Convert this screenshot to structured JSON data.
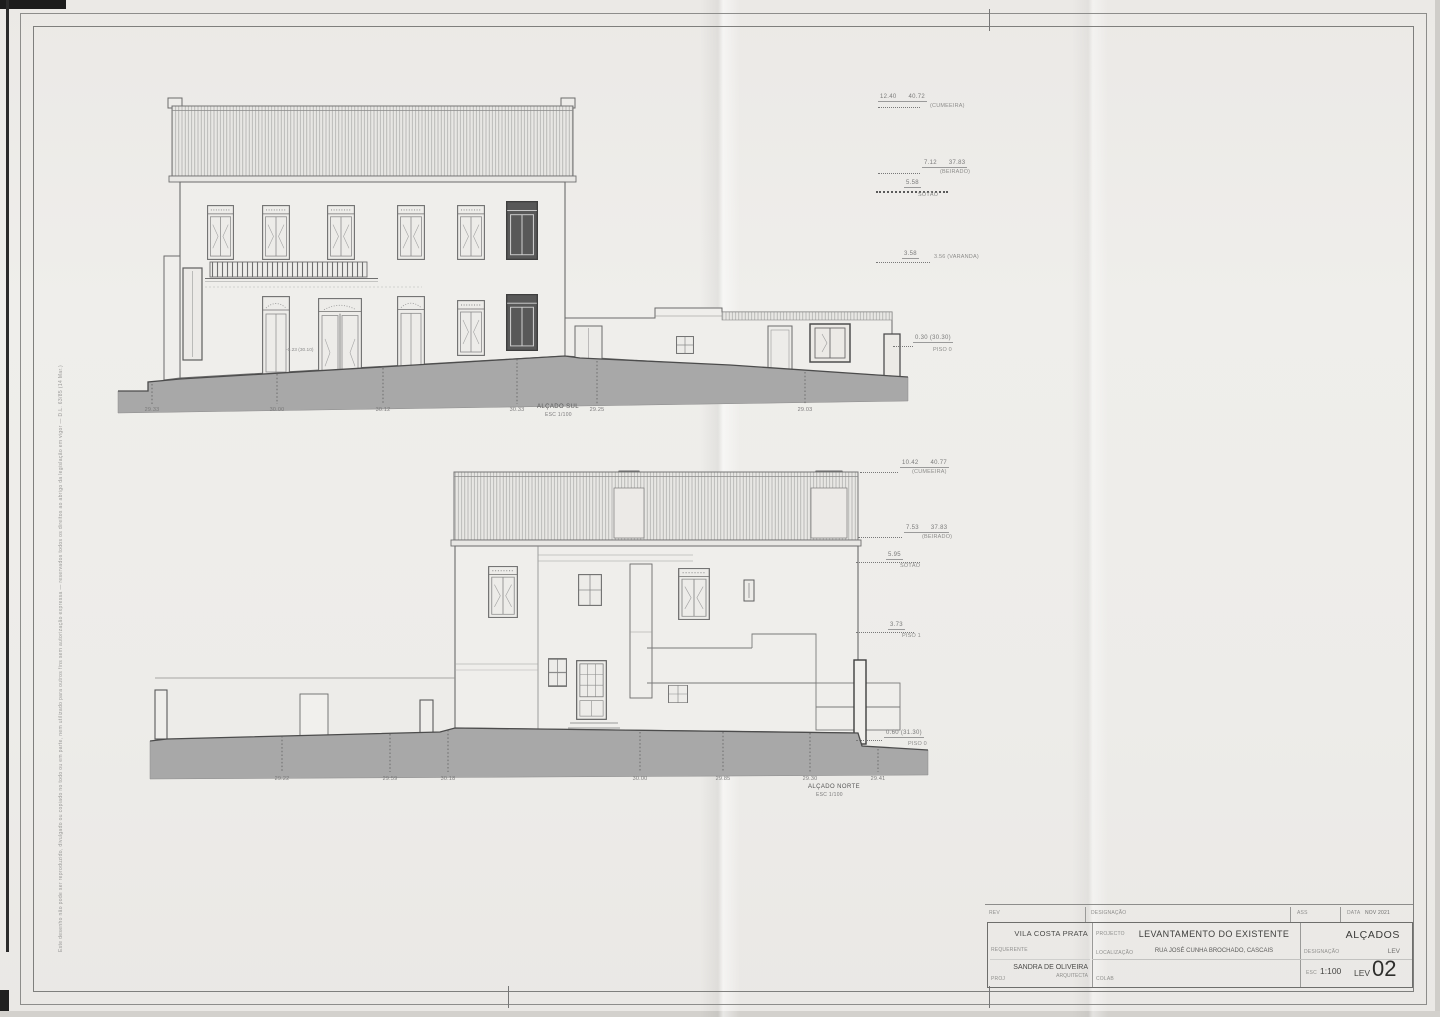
{
  "sheet": {
    "disclaimer": "Este desenho não pode ser reproduzido, divulgado ou copiado no todo ou em parte, nem utilizado para outros fins sem autorização expressa — reservados todos os direitos ao abrigo da legislação em vigor — D.L. 63/85 (14 Mar.)"
  },
  "south": {
    "name": "ALÇADO SUL",
    "scale": "ESC 1/100",
    "spot_note": "-0.23 (30.10)",
    "ground_levels": [
      "29.33",
      "30.00",
      "30.12",
      "30.33",
      "29.25",
      "29.03"
    ],
    "levels": [
      {
        "a": "12.40",
        "b": "40.72",
        "c": "(CUMEEIRA)"
      },
      {
        "a": "7.12",
        "b": "37.83",
        "c": "(BEIRADO)"
      },
      {
        "a": "5.58",
        "b": "",
        "c": "SÓTÃO"
      },
      {
        "a": "3.58",
        "b": "",
        "c": "3.56 (VARANDA)"
      },
      {
        "a": "0.30 (30.30)",
        "b": "",
        "c": "PISO 0"
      }
    ]
  },
  "north": {
    "name": "ALÇADO NORTE",
    "scale": "ESC 1/100",
    "ground_levels": [
      "29.22",
      "29.59",
      "30.18",
      "30.00",
      "29.85",
      "29.30",
      "29.41"
    ],
    "levels": [
      {
        "a": "10.42",
        "b": "40.77",
        "c": "(CUMEEIRA)"
      },
      {
        "a": "7.53",
        "b": "37.83",
        "c": "(BEIRADO)"
      },
      {
        "a": "5.95",
        "b": "",
        "c": "SÓTÃO"
      },
      {
        "a": "3.73",
        "b": "",
        "c": "PISO 1"
      },
      {
        "a": "0.60 (31.30)",
        "b": "",
        "c": "PISO 0"
      }
    ]
  },
  "title_block": {
    "rev_label": "REV",
    "designacao_col_label": "DESIGNAÇÃO",
    "ass_label": "ASS",
    "data_label": "DATA",
    "date": "NOV 2021",
    "client": "VILA COSTA PRATA",
    "client_label": "REQUERENTE",
    "project_label": "PROJECTO",
    "title": "LEVANTAMENTO DO EXISTENTE",
    "location_label": "LOCALIZAÇÃO",
    "location": "RUA JOSÉ CUNHA BROCHADO, CASCAIS",
    "sheet_type": "ALÇADOS",
    "designation_label": "DESIGNAÇÃO",
    "series": "LEV",
    "architect": "SANDRA DE OLIVEIRA",
    "architect_title": "ARQUITECTA",
    "proj_label": "PROJ",
    "colab_label": "COLAB",
    "scale_label": "ESC",
    "scale": "1:100",
    "sheet_code": "LEV",
    "sheet_number": "02"
  }
}
